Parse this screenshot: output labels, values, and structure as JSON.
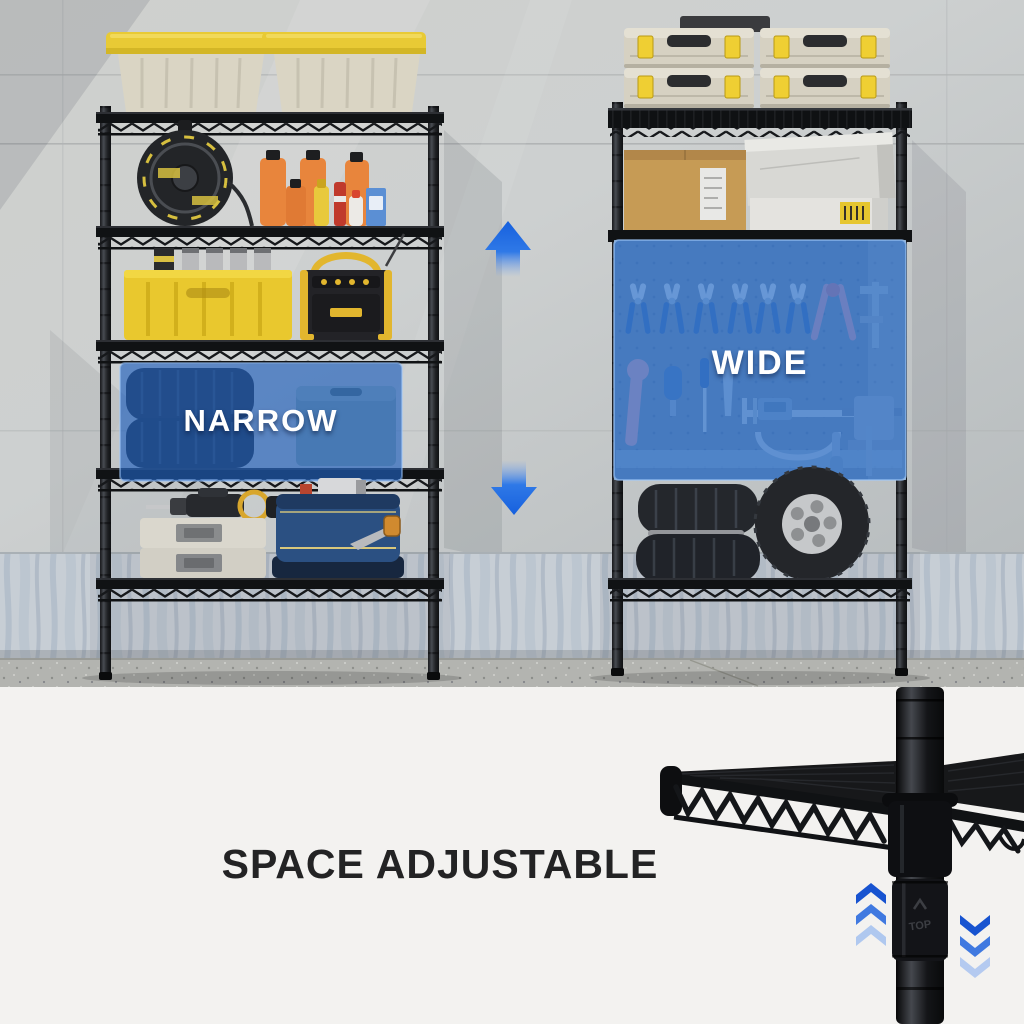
{
  "hero_image": {
    "narrow_overlay": {
      "label": "NARROW"
    },
    "wide_overlay": {
      "label": "WIDE"
    },
    "pole_marking": "TOP"
  },
  "caption": {
    "title": "SPACE ADJUSTABLE"
  },
  "icons": {
    "arrow-up": "▲",
    "arrow-down": "▼",
    "chevrons-up": "⌃⌃⌃",
    "chevrons-down": "⌄⌄⌄"
  },
  "colors": {
    "highlight_blue": "#2f6cc0",
    "arrow_blue": "#1765e3",
    "overlay_label_text": "#ffffff",
    "caption_text": "#232324",
    "panel_background": "#f3f2f0",
    "rack_black": "#141518",
    "tote_lid_yellow": "#e8ca35",
    "case_latch_yellow": "#efcf33",
    "oil_bottle_orange": "#e8853c",
    "crate_yellow": "#e9c82e",
    "toolbag_blue": "#2b4f80"
  }
}
